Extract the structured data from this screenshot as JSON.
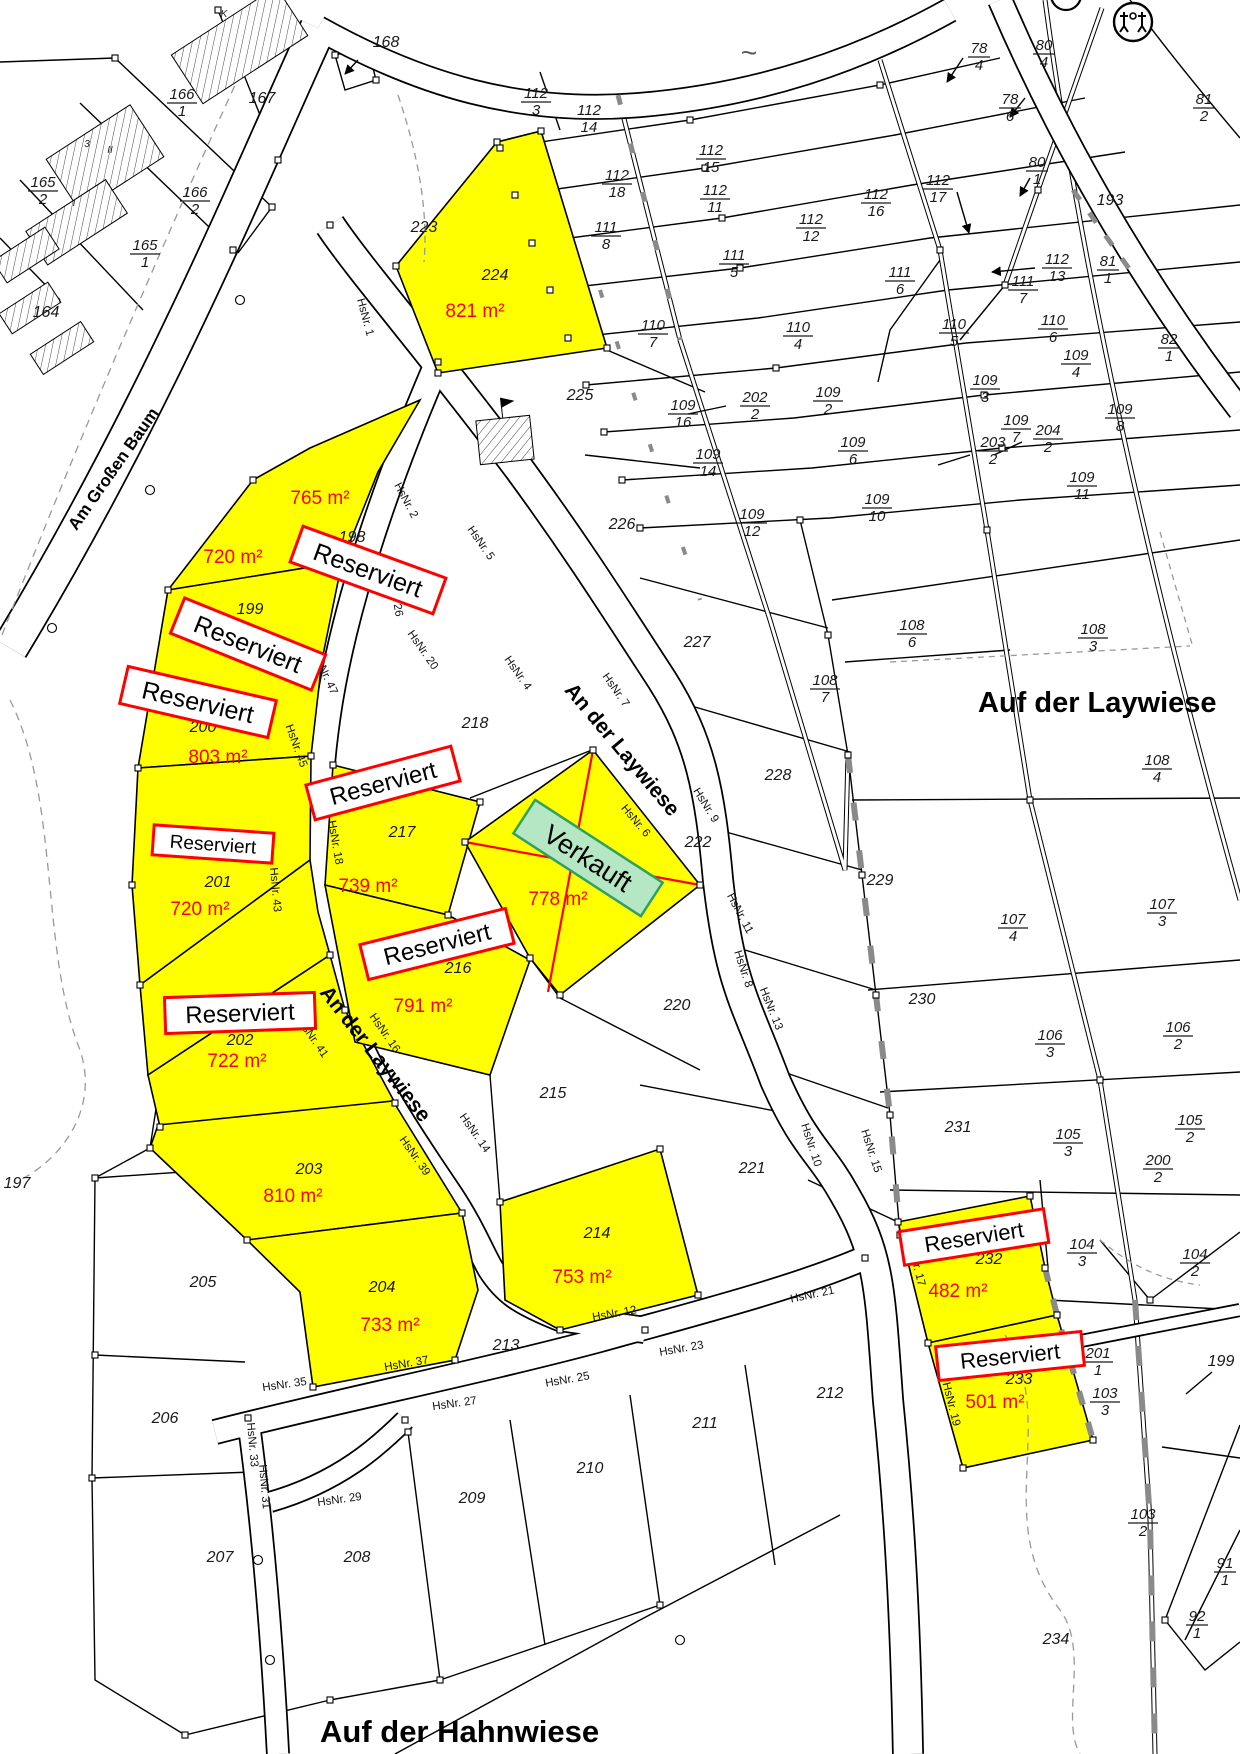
{
  "map": {
    "colors": {
      "plot_highlight": "#ffff00",
      "reserved_border": "#ff0000",
      "reserved_fill": "#ffffff",
      "sold_fill": "#b5e7c4",
      "sold_border": "#2ea05f",
      "area_text": "#ff0000",
      "line": "#000000",
      "gray_marks": "#8a8a8a"
    },
    "street_names": [
      {
        "id": "am-grossen-baum",
        "text": "Am Großen Baum",
        "x": 118,
        "y": 472,
        "rot": -55,
        "size": 17,
        "anchor": "middle"
      },
      {
        "id": "an-der-laywiese-upper",
        "text": "An der Laywiese",
        "x": 617,
        "y": 754,
        "rot": 50,
        "size": 21,
        "anchor": "middle"
      },
      {
        "id": "an-der-laywiese-lower",
        "text": "An der Laywiese",
        "x": 370,
        "y": 1058,
        "rot": 52,
        "size": 21,
        "anchor": "middle"
      },
      {
        "id": "auf-der-laywiese",
        "text": "Auf der Laywiese",
        "x": 978,
        "y": 712,
        "rot": 0,
        "size": 29,
        "anchor": "start"
      },
      {
        "id": "auf-der-hahnwiese",
        "text": "Auf der Hahnwiese",
        "x": 320,
        "y": 1742,
        "rot": 0,
        "size": 31,
        "anchor": "start"
      }
    ],
    "status_badges": [
      {
        "plot": "198",
        "text": "Reserviert",
        "x": 368,
        "y": 570,
        "rot": 20,
        "w": 152,
        "h": 38,
        "fs": 25
      },
      {
        "plot": "199",
        "text": "Reserviert",
        "x": 248,
        "y": 644,
        "rot": 22,
        "w": 152,
        "h": 38,
        "fs": 25
      },
      {
        "plot": "200",
        "text": "Reserviert",
        "x": 198,
        "y": 702,
        "rot": 13,
        "w": 152,
        "h": 38,
        "fs": 25
      },
      {
        "plot": "201",
        "text": "Reserviert",
        "x": 213,
        "y": 844,
        "rot": 4,
        "w": 120,
        "h": 30,
        "fs": 19
      },
      {
        "plot": "202",
        "text": "Reserviert",
        "x": 240,
        "y": 1013,
        "rot": -2,
        "w": 150,
        "h": 36,
        "fs": 24
      },
      {
        "plot": "217",
        "text": "Reserviert",
        "x": 383,
        "y": 783,
        "rot": -15,
        "w": 150,
        "h": 36,
        "fs": 24
      },
      {
        "plot": "216",
        "text": "Reserviert",
        "x": 437,
        "y": 944,
        "rot": -14,
        "w": 150,
        "h": 36,
        "fs": 24
      },
      {
        "plot": "232",
        "text": "Reserviert",
        "x": 974,
        "y": 1237,
        "rot": -9,
        "w": 146,
        "h": 34,
        "fs": 22
      },
      {
        "plot": "233",
        "text": "Reserviert",
        "x": 1010,
        "y": 1356,
        "rot": -6,
        "w": 146,
        "h": 34,
        "fs": 22
      }
    ],
    "sold_badge": {
      "plot": "222",
      "text": "Verkauft",
      "x": 588,
      "y": 858,
      "rot": 33,
      "w": 152,
      "h": 40,
      "fs": 27
    },
    "plot_areas": [
      {
        "plot": "224",
        "text": "821 m²",
        "x": 475,
        "y": 317
      },
      {
        "plot": "198",
        "text": "765 m²",
        "x": 320,
        "y": 504
      },
      {
        "plot": "199",
        "text": "720 m²",
        "x": 233,
        "y": 563
      },
      {
        "plot": "200",
        "text": "803 m²",
        "x": 218,
        "y": 763
      },
      {
        "plot": "201",
        "text": "720 m²",
        "x": 200,
        "y": 915
      },
      {
        "plot": "202",
        "text": "722 m²",
        "x": 237,
        "y": 1067
      },
      {
        "plot": "217",
        "text": "739 m²",
        "x": 368,
        "y": 892
      },
      {
        "plot": "216",
        "text": "791 m²",
        "x": 423,
        "y": 1012
      },
      {
        "plot": "222",
        "text": "778 m²",
        "x": 558,
        "y": 905
      },
      {
        "plot": "203",
        "text": "810 m²",
        "x": 293,
        "y": 1202
      },
      {
        "plot": "204",
        "text": "733 m²",
        "x": 390,
        "y": 1331
      },
      {
        "plot": "214",
        "text": "753 m²",
        "x": 582,
        "y": 1283
      },
      {
        "plot": "232",
        "text": "482 m²",
        "x": 958,
        "y": 1297
      },
      {
        "plot": "233",
        "text": "501 m²",
        "x": 995,
        "y": 1408
      }
    ],
    "parcel_numbers": [
      {
        "text": "167",
        "x": 262,
        "y": 103
      },
      {
        "text": "168",
        "x": 386,
        "y": 47
      },
      {
        "text": "164",
        "x": 46,
        "y": 317
      },
      {
        "text": "193",
        "x": 1110,
        "y": 205
      },
      {
        "text": "197",
        "x": 17,
        "y": 1188
      },
      {
        "text": "198",
        "x": 352,
        "y": 542
      },
      {
        "text": "199",
        "x": 250,
        "y": 614
      },
      {
        "text": "200",
        "x": 203,
        "y": 732
      },
      {
        "text": "201",
        "x": 218,
        "y": 887
      },
      {
        "text": "202",
        "x": 240,
        "y": 1045
      },
      {
        "text": "203",
        "x": 309,
        "y": 1174
      },
      {
        "text": "204",
        "x": 382,
        "y": 1292
      },
      {
        "text": "205",
        "x": 203,
        "y": 1287
      },
      {
        "text": "206",
        "x": 165,
        "y": 1423
      },
      {
        "text": "207",
        "x": 220,
        "y": 1562
      },
      {
        "text": "208",
        "x": 357,
        "y": 1562
      },
      {
        "text": "209",
        "x": 472,
        "y": 1503
      },
      {
        "text": "210",
        "x": 590,
        "y": 1473
      },
      {
        "text": "211",
        "x": 705,
        "y": 1428
      },
      {
        "text": "212",
        "x": 830,
        "y": 1398
      },
      {
        "text": "213",
        "x": 506,
        "y": 1350
      },
      {
        "text": "214",
        "x": 597,
        "y": 1238
      },
      {
        "text": "215",
        "x": 553,
        "y": 1098
      },
      {
        "text": "216",
        "x": 458,
        "y": 973
      },
      {
        "text": "217",
        "x": 402,
        "y": 837
      },
      {
        "text": "218",
        "x": 475,
        "y": 728
      },
      {
        "text": "220",
        "x": 677,
        "y": 1010
      },
      {
        "text": "221",
        "x": 752,
        "y": 1173
      },
      {
        "text": "222",
        "x": 698,
        "y": 847
      },
      {
        "text": "223",
        "x": 424,
        "y": 232
      },
      {
        "text": "224",
        "x": 495,
        "y": 280
      },
      {
        "text": "225",
        "x": 580,
        "y": 400
      },
      {
        "text": "226",
        "x": 622,
        "y": 529
      },
      {
        "text": "227",
        "x": 697,
        "y": 647
      },
      {
        "text": "228",
        "x": 778,
        "y": 780
      },
      {
        "text": "229",
        "x": 880,
        "y": 885
      },
      {
        "text": "230",
        "x": 922,
        "y": 1004
      },
      {
        "text": "231",
        "x": 958,
        "y": 1132
      },
      {
        "text": "232",
        "x": 989,
        "y": 1264
      },
      {
        "text": "233",
        "x": 1019,
        "y": 1384
      },
      {
        "text": "234",
        "x": 1056,
        "y": 1644
      },
      {
        "text": "199",
        "x": 1221,
        "y": 1366
      }
    ],
    "fraction_labels": [
      {
        "num": "166",
        "den": "1",
        "x": 182,
        "y": 102
      },
      {
        "num": "165",
        "den": "2",
        "x": 43,
        "y": 190
      },
      {
        "num": "166",
        "den": "2",
        "x": 195,
        "y": 200
      },
      {
        "num": "165",
        "den": "1",
        "x": 145,
        "y": 253
      },
      {
        "num": "78",
        "den": "4",
        "x": 979,
        "y": 56
      },
      {
        "num": "80",
        "den": "4",
        "x": 1044,
        "y": 53
      },
      {
        "num": "78",
        "den": "6",
        "x": 1010,
        "y": 107
      },
      {
        "num": "81",
        "den": "2",
        "x": 1204,
        "y": 107
      },
      {
        "num": "80",
        "den": "1",
        "x": 1037,
        "y": 170
      },
      {
        "num": "112",
        "den": "3",
        "x": 536,
        "y": 101
      },
      {
        "num": "112",
        "den": "14",
        "x": 589,
        "y": 118
      },
      {
        "num": "112",
        "den": "15",
        "x": 711,
        "y": 158
      },
      {
        "num": "112",
        "den": "18",
        "x": 617,
        "y": 183
      },
      {
        "num": "112",
        "den": "11",
        "x": 715,
        "y": 198
      },
      {
        "num": "112",
        "den": "16",
        "x": 876,
        "y": 202
      },
      {
        "num": "112",
        "den": "17",
        "x": 938,
        "y": 188
      },
      {
        "num": "112",
        "den": "12",
        "x": 811,
        "y": 227
      },
      {
        "num": "112",
        "den": "13",
        "x": 1057,
        "y": 267
      },
      {
        "num": "111",
        "den": "8",
        "x": 606,
        "y": 235
      },
      {
        "num": "111",
        "den": "5",
        "x": 734,
        "y": 263
      },
      {
        "num": "111",
        "den": "6",
        "x": 900,
        "y": 280
      },
      {
        "num": "111",
        "den": "7",
        "x": 1023,
        "y": 289
      },
      {
        "num": "81",
        "den": "1",
        "x": 1108,
        "y": 269
      },
      {
        "num": "82",
        "den": "1",
        "x": 1169,
        "y": 347
      },
      {
        "num": "110",
        "den": "7",
        "x": 653,
        "y": 333
      },
      {
        "num": "110",
        "den": "4",
        "x": 798,
        "y": 335
      },
      {
        "num": "110",
        "den": "5",
        "x": 954,
        "y": 332
      },
      {
        "num": "110",
        "den": "6",
        "x": 1053,
        "y": 328
      },
      {
        "num": "109",
        "den": "16",
        "x": 683,
        "y": 413
      },
      {
        "num": "202",
        "den": "2",
        "x": 755,
        "y": 405
      },
      {
        "num": "109",
        "den": "2",
        "x": 828,
        "y": 400
      },
      {
        "num": "109",
        "den": "3",
        "x": 985,
        "y": 388
      },
      {
        "num": "109",
        "den": "4",
        "x": 1076,
        "y": 363
      },
      {
        "num": "109",
        "den": "14",
        "x": 708,
        "y": 462
      },
      {
        "num": "109",
        "den": "6",
        "x": 853,
        "y": 450
      },
      {
        "num": "109",
        "den": "7",
        "x": 1016,
        "y": 428
      },
      {
        "num": "203",
        "den": "2",
        "x": 993,
        "y": 450
      },
      {
        "num": "204",
        "den": "2",
        "x": 1048,
        "y": 438
      },
      {
        "num": "109",
        "den": "8",
        "x": 1120,
        "y": 417
      },
      {
        "num": "109",
        "den": "12",
        "x": 752,
        "y": 522
      },
      {
        "num": "109",
        "den": "10",
        "x": 877,
        "y": 507
      },
      {
        "num": "109",
        "den": "11",
        "x": 1082,
        "y": 485
      },
      {
        "num": "108",
        "den": "6",
        "x": 912,
        "y": 633
      },
      {
        "num": "108",
        "den": "7",
        "x": 825,
        "y": 688
      },
      {
        "num": "108",
        "den": "3",
        "x": 1093,
        "y": 637
      },
      {
        "num": "108",
        "den": "4",
        "x": 1157,
        "y": 768
      },
      {
        "num": "107",
        "den": "4",
        "x": 1013,
        "y": 927
      },
      {
        "num": "107",
        "den": "3",
        "x": 1162,
        "y": 912
      },
      {
        "num": "106",
        "den": "3",
        "x": 1050,
        "y": 1043
      },
      {
        "num": "106",
        "den": "2",
        "x": 1178,
        "y": 1035
      },
      {
        "num": "105",
        "den": "3",
        "x": 1068,
        "y": 1142
      },
      {
        "num": "105",
        "den": "2",
        "x": 1190,
        "y": 1128
      },
      {
        "num": "200",
        "den": "2",
        "x": 1158,
        "y": 1168
      },
      {
        "num": "104",
        "den": "3",
        "x": 1082,
        "y": 1252
      },
      {
        "num": "104",
        "den": "2",
        "x": 1195,
        "y": 1262
      },
      {
        "num": "201",
        "den": "1",
        "x": 1098,
        "y": 1361
      },
      {
        "num": "103",
        "den": "3",
        "x": 1105,
        "y": 1401
      },
      {
        "num": "103",
        "den": "2",
        "x": 1143,
        "y": 1522
      },
      {
        "num": "91",
        "den": "1",
        "x": 1225,
        "y": 1571
      },
      {
        "num": "92",
        "den": "1",
        "x": 1197,
        "y": 1624
      }
    ],
    "house_numbers": [
      {
        "text": "HsNr. 1",
        "x": 362,
        "y": 318,
        "rot": 75
      },
      {
        "text": "HsNr. 2",
        "x": 403,
        "y": 502,
        "rot": 62
      },
      {
        "text": "HsNr. 4",
        "x": 515,
        "y": 675,
        "rot": 55
      },
      {
        "text": "HsNr. 5",
        "x": 478,
        "y": 545,
        "rot": 55
      },
      {
        "text": "HsNr. 7",
        "x": 613,
        "y": 692,
        "rot": 55
      },
      {
        "text": "HsNr. 6",
        "x": 633,
        "y": 823,
        "rot": 50
      },
      {
        "text": "HsNr. 9",
        "x": 703,
        "y": 807,
        "rot": 58
      },
      {
        "text": "HsNr. 8",
        "x": 740,
        "y": 970,
        "rot": 72
      },
      {
        "text": "HsNr. 11",
        "x": 737,
        "y": 915,
        "rot": 62
      },
      {
        "text": "HsNr. 13",
        "x": 768,
        "y": 1010,
        "rot": 68
      },
      {
        "text": "HsNr. 10",
        "x": 808,
        "y": 1146,
        "rot": 72
      },
      {
        "text": "HsNr. 15",
        "x": 868,
        "y": 1152,
        "rot": 72
      },
      {
        "text": "HsNr. 17",
        "x": 913,
        "y": 1265,
        "rot": 76
      },
      {
        "text": "HsNr. 19",
        "x": 948,
        "y": 1405,
        "rot": 76
      },
      {
        "text": "HsNr. 21",
        "x": 813,
        "y": 1298,
        "rot": -12
      },
      {
        "text": "HsNr. 23",
        "x": 682,
        "y": 1352,
        "rot": -10
      },
      {
        "text": "HsNr. 25",
        "x": 568,
        "y": 1383,
        "rot": -10
      },
      {
        "text": "HsNr. 27",
        "x": 455,
        "y": 1407,
        "rot": -8
      },
      {
        "text": "HsNr. 29",
        "x": 340,
        "y": 1503,
        "rot": -8
      },
      {
        "text": "HsNr. 31",
        "x": 261,
        "y": 1487,
        "rot": 85
      },
      {
        "text": "HsNr. 33",
        "x": 249,
        "y": 1445,
        "rot": 85
      },
      {
        "text": "HsNr. 35",
        "x": 285,
        "y": 1388,
        "rot": -8
      },
      {
        "text": "HsNr. 37",
        "x": 407,
        "y": 1367,
        "rot": -10
      },
      {
        "text": "HsNr. 39",
        "x": 412,
        "y": 1158,
        "rot": 55
      },
      {
        "text": "HsNr. 41",
        "x": 310,
        "y": 1040,
        "rot": 55
      },
      {
        "text": "HsNr. 43",
        "x": 272,
        "y": 890,
        "rot": 85
      },
      {
        "text": "HsNr. 45",
        "x": 293,
        "y": 747,
        "rot": 70
      },
      {
        "text": "HsNr. 47",
        "x": 322,
        "y": 675,
        "rot": 65
      },
      {
        "text": "HsNr. 12",
        "x": 615,
        "y": 1317,
        "rot": -10
      },
      {
        "text": "HsNr. 14",
        "x": 472,
        "y": 1135,
        "rot": 55
      },
      {
        "text": "HsNr. 16",
        "x": 382,
        "y": 1035,
        "rot": 55
      },
      {
        "text": "HsNr. 18",
        "x": 332,
        "y": 843,
        "rot": 80
      },
      {
        "text": "HsNr. 20",
        "x": 420,
        "y": 652,
        "rot": 55
      },
      {
        "text": "HsNr. 26",
        "x": 392,
        "y": 595,
        "rot": 80
      }
    ],
    "micro_labels": [
      {
        "text": "II",
        "x": 110,
        "y": 153
      },
      {
        "text": "I",
        "x": 74,
        "y": 206
      },
      {
        "text": "3",
        "x": 87,
        "y": 147
      },
      {
        "text": "K",
        "x": 224,
        "y": 17
      }
    ],
    "symbols": [
      {
        "name": "tilde-water-mark",
        "text": "~",
        "x": 749,
        "y": 62
      },
      {
        "name": "playground-icon",
        "x": 1133,
        "y": 22
      }
    ]
  }
}
